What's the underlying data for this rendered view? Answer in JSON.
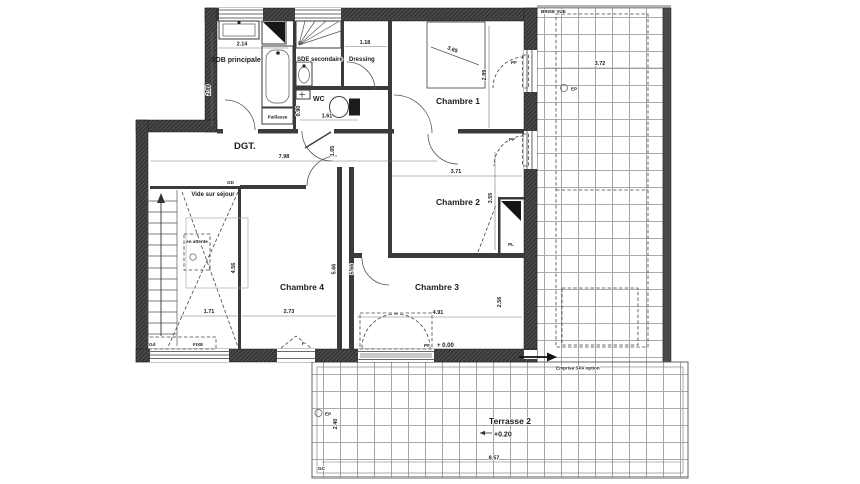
{
  "colors": {
    "wall": "#383838",
    "line": "#555555",
    "tile_grid": "#8f8f8f",
    "text": "#1d1d1d"
  },
  "labels": {
    "sdb": "SDB principale",
    "sde": "SDE secondaire",
    "dressing": "Dressing",
    "wc": "WC",
    "chambre1": "Chambre 1",
    "chambre2": "Chambre 2",
    "chambre3": "Chambre 3",
    "chambre4": "Chambre 4",
    "dgt": "DGT.",
    "vide": "Vide sur séjour",
    "paillasse": "Paillasse",
    "en_attente": "en attente",
    "gd": "GD",
    "gd2": "Gd",
    "fixe": "FIXE",
    "f": "F",
    "pf": "PF",
    "pl": "PL",
    "ep": "EP",
    "gc": "GC",
    "level_zero": "+ 0.00",
    "level_terrace": "+0.20",
    "terrasse2": "Terrasse 2",
    "brise_vue": "BRISE VUE",
    "emprise_spa": "Emprise SPA option"
  },
  "dims": {
    "sdb_w": "2.14",
    "sdb_h": "2.89",
    "dressing_w": "1.18",
    "bed_diag": "3.65",
    "ch1_h": "2.89",
    "wc_w": "1.61",
    "wc_h": "0.90",
    "dgt_w": "7.98",
    "dgt_h": "1.05",
    "ch2_w": "3.71",
    "ch2_h": "3.55",
    "vide_w": "1.71",
    "vide_h": "4.56",
    "ch4_w": "2.73",
    "wall_a": "5.66",
    "wall_b": "5.66",
    "ch3_w": "4.91",
    "ch3_h": "2.56",
    "terrace_right_w": "3.72",
    "terrasse2_w": "8.57",
    "terrasse2_h": "2.40"
  }
}
